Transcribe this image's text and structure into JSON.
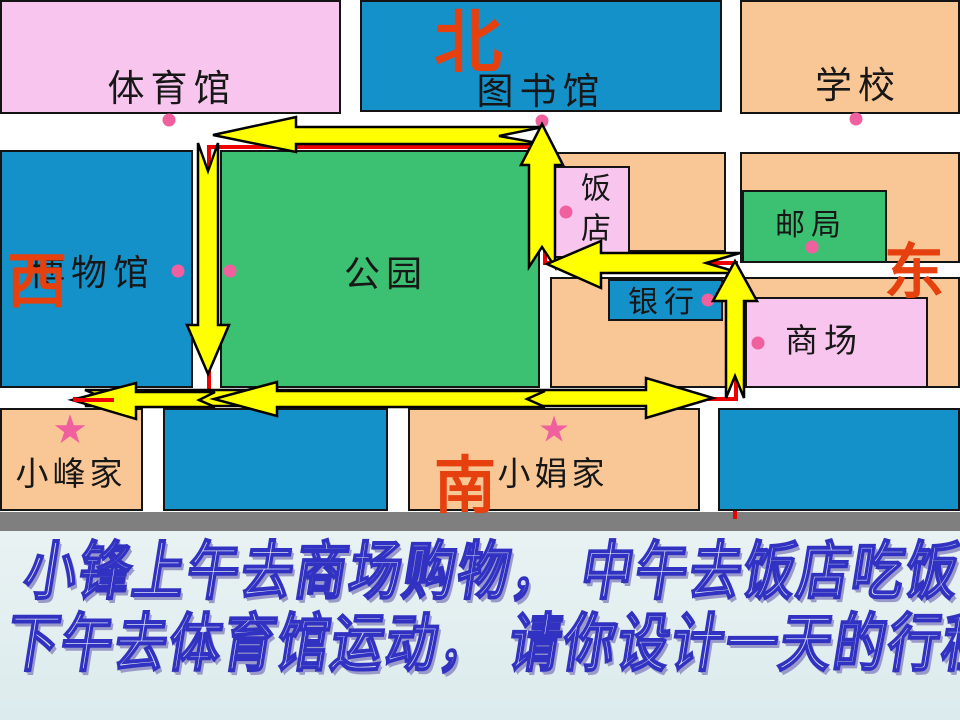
{
  "directions": {
    "north": "北",
    "south": "南",
    "west": "西",
    "east": "东"
  },
  "places": {
    "gym": {
      "label": "体育馆"
    },
    "library": {
      "label": "图书馆"
    },
    "school": {
      "label": "学校"
    },
    "museum": {
      "label": "博物馆"
    },
    "park": {
      "label": "公园"
    },
    "restaurant": {
      "label": "饭店"
    },
    "post_office": {
      "label": "邮局"
    },
    "bank": {
      "label": "银行"
    },
    "mall": {
      "label": "商场"
    },
    "xiaofeng_home": {
      "label": "小峰家"
    },
    "xiaojuan_home": {
      "label": "小娟家"
    }
  },
  "markers": {
    "star": "★"
  },
  "question": {
    "line1": "小锋上午去商场购物， 中午去饭店吃饭",
    "line2": "下午去体育馆运动， 请你设计一天的行程路线？"
  },
  "colors": {
    "block_pink": "#f8c5ee",
    "block_blue": "#1591c9",
    "block_orange": "#f9c795",
    "block_green": "#3cc172",
    "road_white": "#ffffff",
    "direction_red": "#e5400e",
    "marker_pink": "#f0609e",
    "route_arrow_yellow": "#ffff00",
    "route_line_red": "#ee0000",
    "divider_gray": "#7f7f7f",
    "question_background": "#e3eff0",
    "question_text_blue": "#3232c2"
  }
}
